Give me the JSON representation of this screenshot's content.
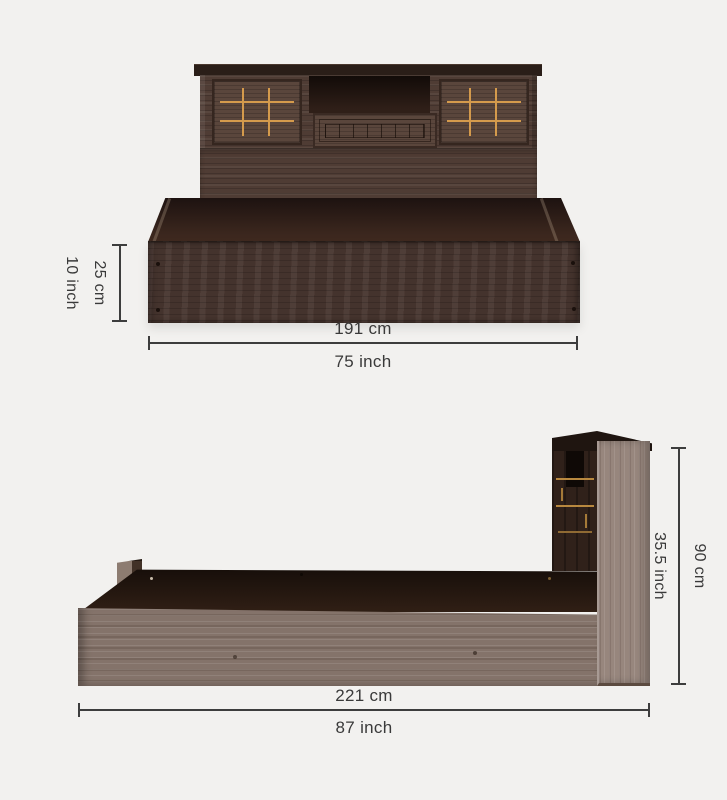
{
  "front_view": {
    "height": {
      "cm": "25 cm",
      "inch": "10 inch"
    },
    "width": {
      "cm": "191 cm",
      "inch": "75 inch"
    }
  },
  "side_view": {
    "height": {
      "inch": "35.5 inch",
      "cm": "90 cm"
    },
    "length": {
      "cm": "221 cm",
      "inch": "87 inch"
    }
  },
  "colors": {
    "background": "#f2f1ef",
    "dimension_line": "#3d3d3d",
    "label_text": "#3a3a3a",
    "dark_wood": "#4f3c34",
    "light_wood": "#93827a",
    "gold_inlay": "#d49a4c",
    "deck_shadow": "#1d1210"
  }
}
